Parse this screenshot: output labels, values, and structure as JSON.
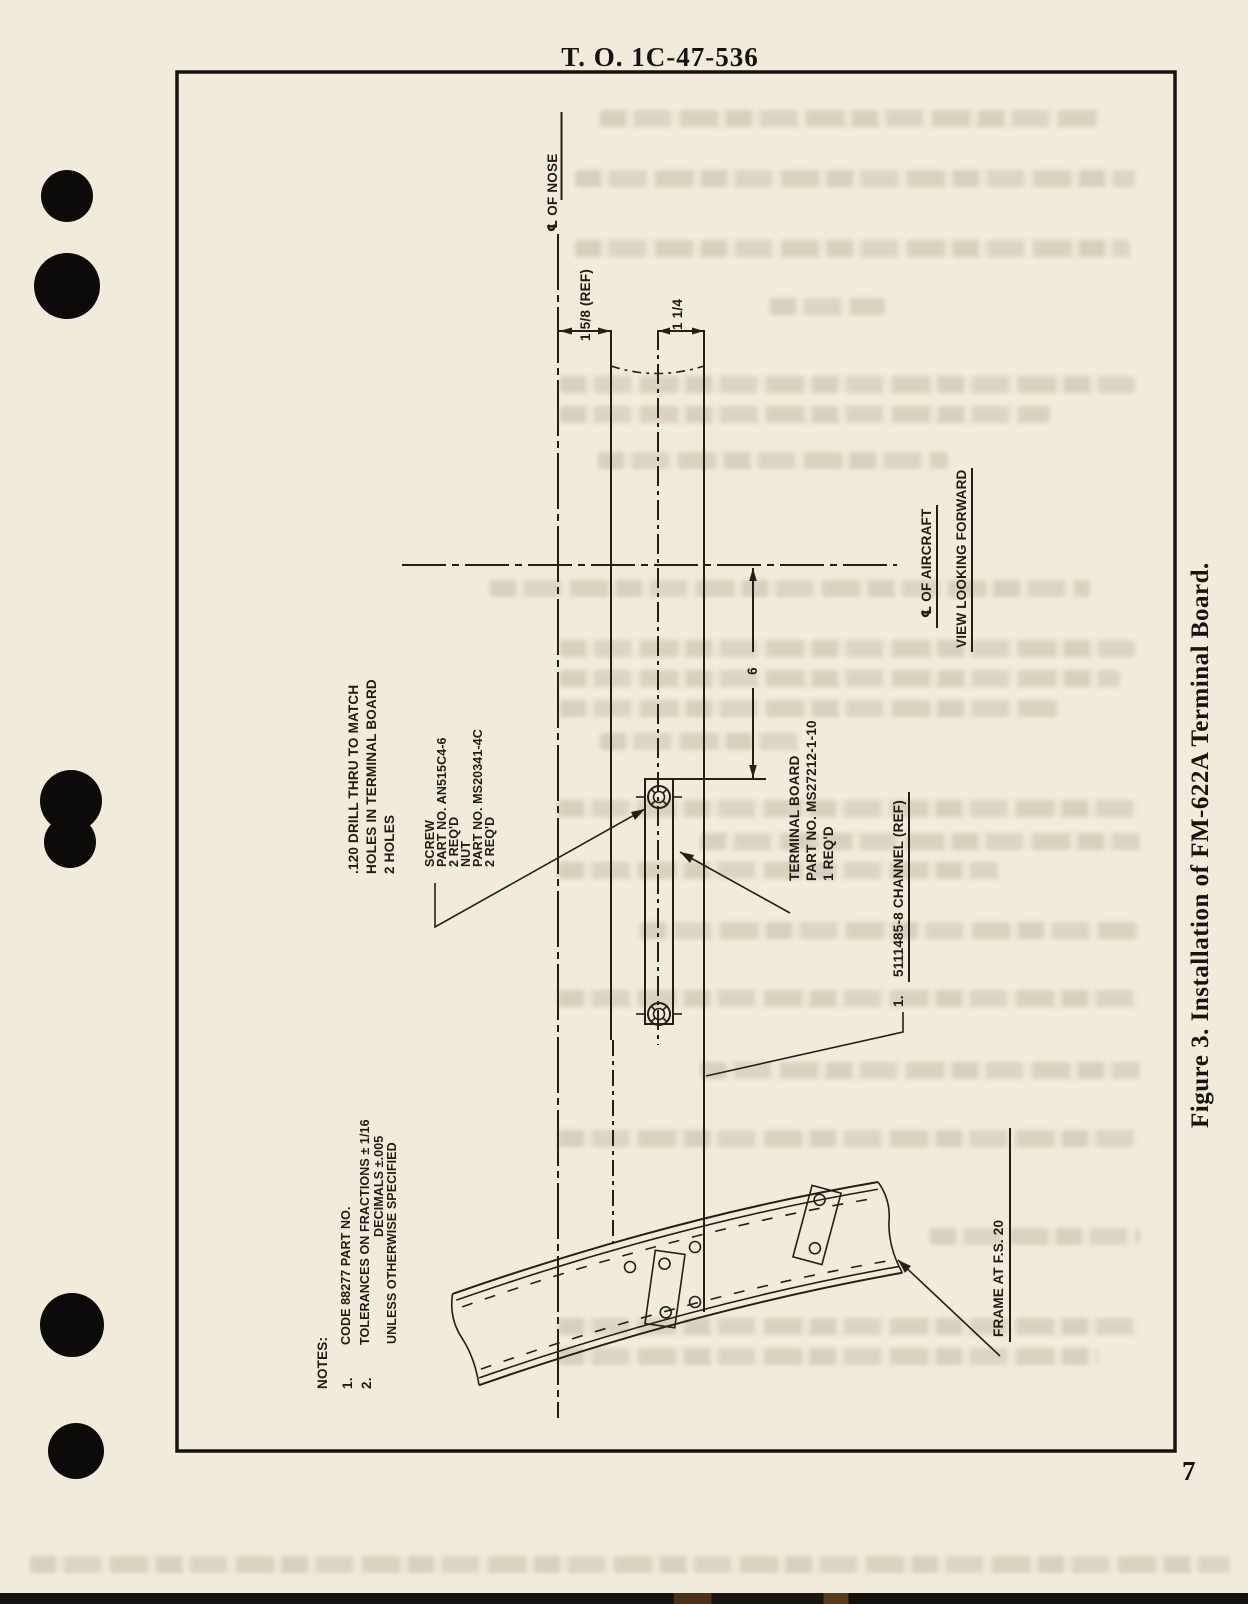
{
  "header": {
    "title": "T. O. 1C-47-536"
  },
  "page_number": "7",
  "caption": "Figure 3.  Installation of FM-622A Terminal Board.",
  "drawing": {
    "nose_centerline": {
      "label": "℄ OF NOSE"
    },
    "aircraft_centerline": {
      "label": "℄ OF AIRCRAFT",
      "view_label": "VIEW LOOKING FORWARD"
    },
    "dimensions": {
      "ref_width": "1 5/8 (REF)",
      "board_width": "1 1/4",
      "height": "6"
    },
    "drill_note": {
      "lines": [
        ".120 DRILL THRU TO MATCH",
        "HOLES IN TERMINAL BOARD",
        "2 HOLES"
      ]
    },
    "screw_note": {
      "lines": [
        "SCREW",
        "PART NO.  AN515C4-6",
        "2 REQ'D",
        "NUT",
        "PART NO.  MS20341-4C",
        "2 REQ'D"
      ]
    },
    "terminal_board_note": {
      "lines": [
        "TERMINAL BOARD",
        "PART NO.  MS27212-1-10",
        "1 REQ'D"
      ]
    },
    "channel_note": {
      "num": "1.",
      "text": "5111485-8 CHANNEL (REF)"
    },
    "frame_note": "FRAME AT F.S. 20",
    "notes": {
      "heading": "NOTES:",
      "item1_num": "1.",
      "item1_text": "CODE 88277 PART NO.",
      "item2_num": "2.",
      "item2_line1": "TOLERANCES ON FRACTIONS ± 1/16",
      "item2_line2": "DECIMALS ±.005",
      "item2_line3": "UNLESS OTHERWISE SPECIFIED"
    }
  },
  "colors": {
    "paper": "#f0ebda",
    "ink": "#241f17",
    "ghost": "#766c52"
  }
}
